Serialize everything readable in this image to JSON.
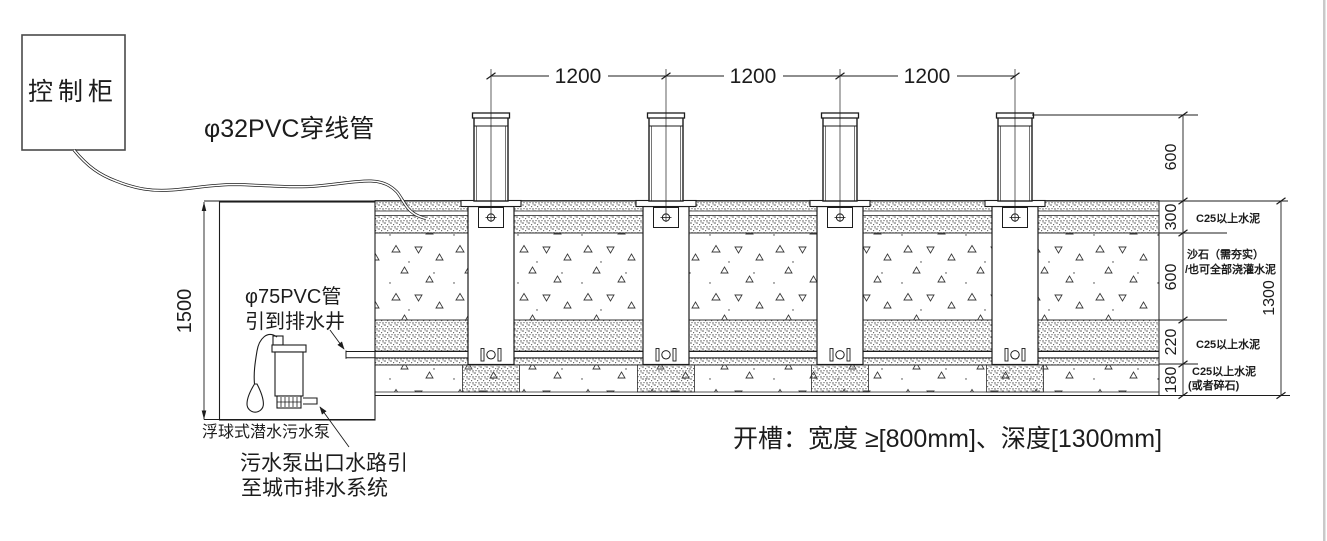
{
  "labels": {
    "control_cabinet": "控制柜",
    "conduit": "φ32PVC穿线管",
    "drain_pipe_1": "φ75PVC管",
    "drain_pipe_2": "引到排水井",
    "pump": "浮球式潜水污水泵",
    "pump_outlet_1": "污水泵出口水路引",
    "pump_outlet_2": "至城市排水系统",
    "trench_note": "开槽：宽度  ≥[800mm]、深度[1300mm]"
  },
  "dimensions": {
    "bollard_spacing": [
      "1200",
      "1200",
      "1200"
    ],
    "bollard_exposed_height": "600",
    "layer1": "300",
    "layer2": "600",
    "layer3": "220",
    "layer4": "180",
    "trench_depth": "1300",
    "pit_depth": "1500"
  },
  "materials": {
    "layer1": "C25以上水泥",
    "layer2_line1": "沙石（需夯实）",
    "layer2_line2": "/也可全部浇灌水泥",
    "layer3": "C25以上水泥",
    "layer4_line1": "C25以上水泥",
    "layer4_line2": "(或者碎石)"
  },
  "colors": {
    "line": "#1c1c1c",
    "background": "#ffffff",
    "edge_strip": "#c9c9c9"
  }
}
